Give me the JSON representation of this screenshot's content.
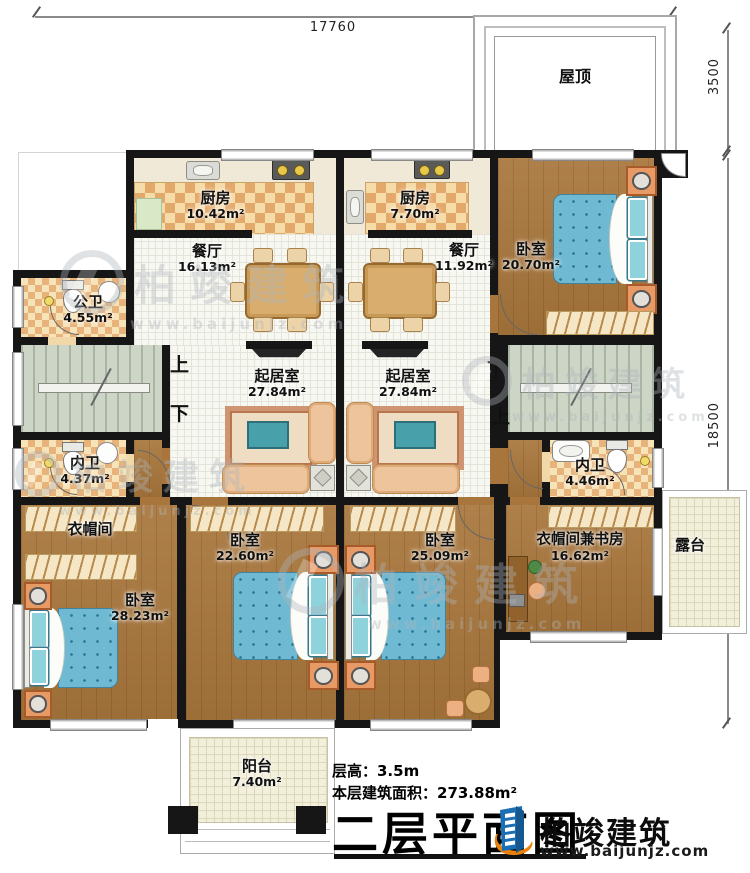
{
  "plan": {
    "dims": {
      "top": "17760",
      "roof_side": "3500",
      "main_side": "18500"
    },
    "roof_label": "屋顶",
    "stairs": {
      "up": "上",
      "down": "下"
    }
  },
  "rooms": {
    "kitchen1": {
      "name": "厨房",
      "area": "10.42m²"
    },
    "kitchen2": {
      "name": "厨房",
      "area": "7.70m²"
    },
    "dining1": {
      "name": "餐厅",
      "area": "16.13m²"
    },
    "dining2": {
      "name": "餐厅",
      "area": "11.92m²"
    },
    "bedroom_top": {
      "name": "卧室",
      "area": "20.70m²"
    },
    "public_bath": {
      "name": "公卫",
      "area": "4.55m²"
    },
    "living1": {
      "name": "起居室",
      "area": "27.84m²"
    },
    "living2": {
      "name": "起居室",
      "area": "27.84m²"
    },
    "bath_left": {
      "name": "内卫",
      "area": "4.37m²"
    },
    "bath_right": {
      "name": "内卫",
      "area": "4.46m²"
    },
    "cloakroom": {
      "name": "衣帽间"
    },
    "bedroom_left": {
      "name": "卧室",
      "area": "28.23m²"
    },
    "bedroom_mid": {
      "name": "卧室",
      "area": "22.60m²"
    },
    "bedroom_right": {
      "name": "卧室",
      "area": "25.09m²"
    },
    "study": {
      "name": "衣帽间兼书房",
      "area": "16.62m²"
    },
    "terrace": {
      "name": "露台"
    },
    "balcony": {
      "name": "阳台",
      "area": "7.40m²"
    }
  },
  "footer": {
    "floor_height": "层高：3.5m",
    "floor_area": "本层建筑面积：273.88m²",
    "title": "二层平面图"
  },
  "brand": {
    "name": "柏竣建筑",
    "url": "www.baijunjz.com"
  },
  "watermark": {
    "name": "柏竣建筑",
    "url": "www.baijunjz.com"
  }
}
